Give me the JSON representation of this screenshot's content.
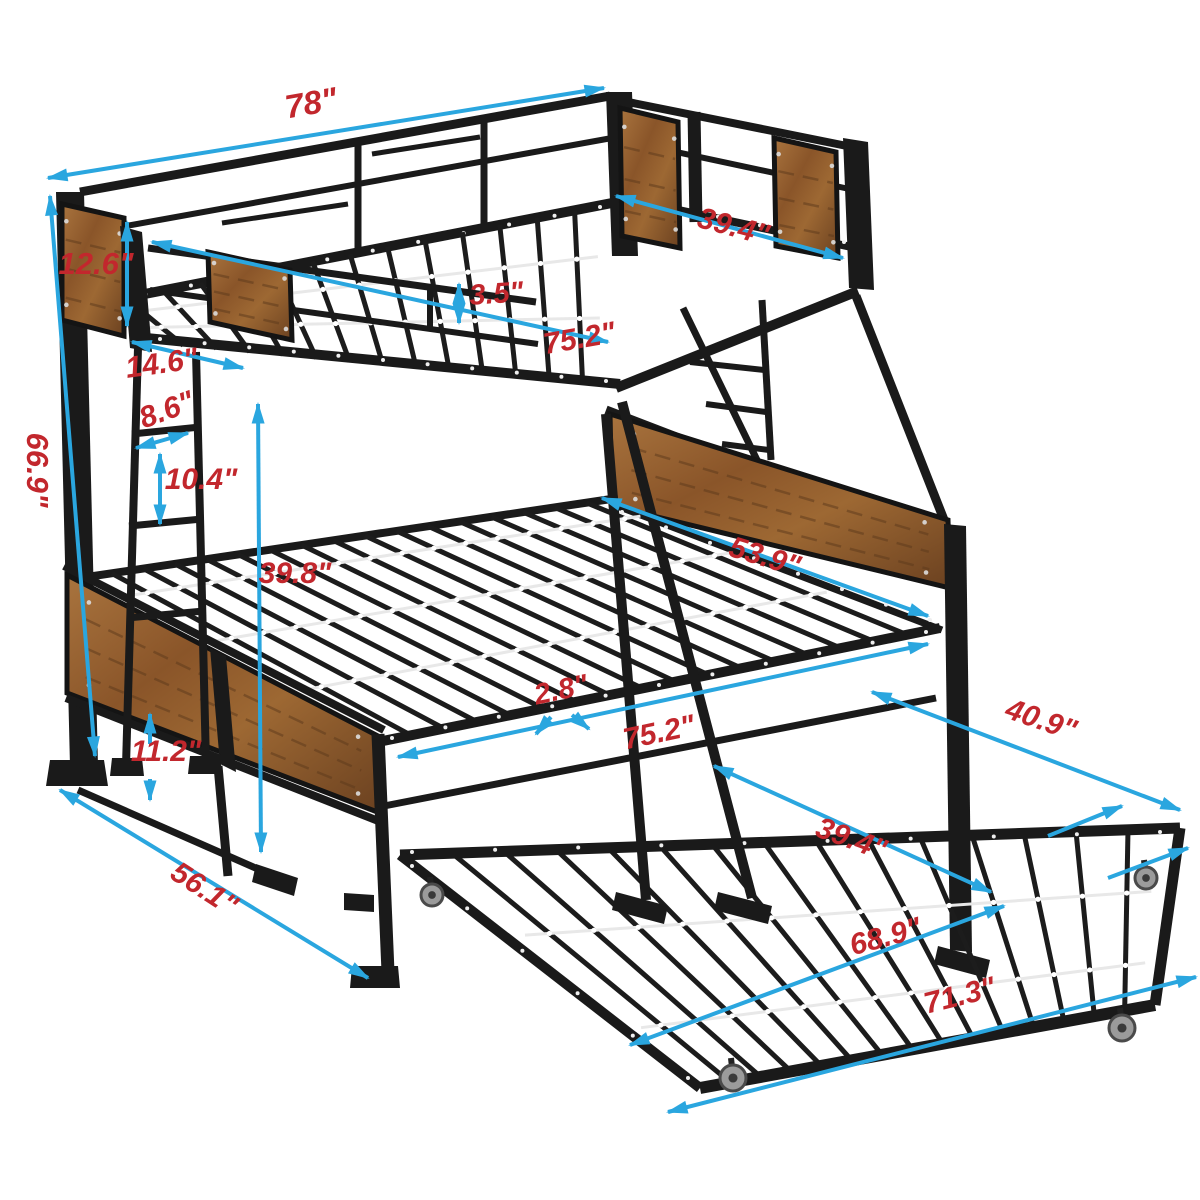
{
  "diagram": {
    "subject": "twin-over-full metal bunk bed with pull-out trundle",
    "unit": "inches",
    "colors": {
      "background": "#ffffff",
      "metal": "#1a1a1a",
      "metal_soft": "#242424",
      "wood_light": "#a9743e",
      "wood_mid": "#8a5529",
      "wood_dark": "#6b4120",
      "wood_grain": "#5d3a1c",
      "dimension_line": "#2AA6DF",
      "dimension_text": "#C2272D",
      "slat_rod": "#e8e8e8",
      "rod_clip": "#ffffff",
      "screw_dot": "#efefef",
      "caster_wheel": "#9b9b9b",
      "caster_hub": "#3a3a3a"
    },
    "dimensions": [
      {
        "id": "overall-length",
        "label": "78\"",
        "value": 78,
        "pos": {
          "x": 313,
          "y": 114,
          "rot": -10,
          "size": 33
        },
        "lines": [
          {
            "x1": 48,
            "y1": 178,
            "x2": 604,
            "y2": 88,
            "heads": "both"
          }
        ]
      },
      {
        "id": "overall-height",
        "label": "66.9\"",
        "value": 66.9,
        "pos": {
          "x": 27,
          "y": 470,
          "rot": 90,
          "size": 31
        },
        "lines": [
          {
            "x1": 50,
            "y1": 196,
            "x2": 95,
            "y2": 756,
            "heads": "both"
          }
        ]
      },
      {
        "id": "upper-panel-height",
        "label": "12.6\"",
        "value": 12.6,
        "pos": {
          "x": 96,
          "y": 274,
          "rot": 0,
          "size": 31
        },
        "lines": [
          {
            "x1": 127,
            "y1": 222,
            "x2": 127,
            "y2": 326,
            "heads": "both"
          }
        ]
      },
      {
        "id": "upper-width",
        "label": "39.4\"",
        "value": 39.4,
        "pos": {
          "x": 731,
          "y": 236,
          "rot": 15,
          "size": 30
        },
        "lines": [
          {
            "x1": 616,
            "y1": 196,
            "x2": 843,
            "y2": 258,
            "heads": "both"
          }
        ]
      },
      {
        "id": "guardrail-height",
        "label": "3.5\"",
        "value": 3.5,
        "pos": {
          "x": 497,
          "y": 303,
          "rot": -4,
          "size": 29
        },
        "lines": [
          {
            "x1": 459,
            "y1": 284,
            "x2": 459,
            "y2": 323,
            "heads": "both"
          }
        ]
      },
      {
        "id": "upper-sleep-length",
        "label": "75.2\"",
        "value": 75.2,
        "pos": {
          "x": 581,
          "y": 348,
          "rot": -10,
          "size": 30
        },
        "lines": [
          {
            "x1": 152,
            "y1": 242,
            "x2": 608,
            "y2": 342,
            "heads": "both"
          }
        ]
      },
      {
        "id": "ladder-depth",
        "label": "14.6\"",
        "value": 14.6,
        "pos": {
          "x": 163,
          "y": 373,
          "rot": -8,
          "size": 30
        },
        "lines": [
          {
            "x1": 132,
            "y1": 342,
            "x2": 243,
            "y2": 368,
            "heads": "both"
          }
        ]
      },
      {
        "id": "rung-width",
        "label": "8.6\"",
        "value": 8.6,
        "pos": {
          "x": 170,
          "y": 419,
          "rot": -20,
          "size": 30
        },
        "lines": [
          {
            "x1": 136,
            "y1": 448,
            "x2": 188,
            "y2": 433,
            "heads": "both"
          }
        ]
      },
      {
        "id": "rung-spacing",
        "label": "10.4\"",
        "value": 10.4,
        "pos": {
          "x": 201,
          "y": 489,
          "rot": 0,
          "size": 30
        },
        "lines": [
          {
            "x1": 160,
            "y1": 454,
            "x2": 160,
            "y2": 524,
            "heads": "both"
          }
        ]
      },
      {
        "id": "bunk-clearance",
        "label": "39.8\"",
        "value": 39.8,
        "pos": {
          "x": 295,
          "y": 583,
          "rot": 0,
          "size": 30
        },
        "lines": [
          {
            "x1": 258,
            "y1": 404,
            "x2": 261,
            "y2": 852,
            "heads": "both"
          }
        ]
      },
      {
        "id": "lower-panel-gap",
        "label": "11.2\"",
        "value": 11.2,
        "pos": {
          "x": 166,
          "y": 761,
          "rot": 0,
          "size": 30
        },
        "lines": [
          {
            "x1": 150,
            "y1": 744,
            "x2": 150,
            "y2": 714,
            "heads": "end"
          },
          {
            "x1": 150,
            "y1": 779,
            "x2": 150,
            "y2": 800,
            "heads": "end"
          }
        ]
      },
      {
        "id": "lower-depth",
        "label": "56.1\"",
        "value": 56.1,
        "pos": {
          "x": 199,
          "y": 897,
          "rot": 33,
          "size": 30
        },
        "lines": [
          {
            "x1": 60,
            "y1": 790,
            "x2": 368,
            "y2": 978,
            "heads": "both"
          }
        ]
      },
      {
        "id": "lower-width",
        "label": "53.9\"",
        "value": 53.9,
        "pos": {
          "x": 762,
          "y": 566,
          "rot": 17,
          "size": 30
        },
        "lines": [
          {
            "x1": 602,
            "y1": 498,
            "x2": 928,
            "y2": 616,
            "heads": "both"
          }
        ]
      },
      {
        "id": "slat-spacing",
        "label": "2.8\"",
        "value": 2.8,
        "pos": {
          "x": 563,
          "y": 699,
          "rot": -12,
          "size": 29
        },
        "lines": [
          {
            "x1": 551,
            "y1": 717,
            "x2": 536,
            "y2": 734,
            "heads": "end"
          },
          {
            "x1": 572,
            "y1": 715,
            "x2": 589,
            "y2": 729,
            "heads": "end"
          }
        ]
      },
      {
        "id": "lower-sleep-length",
        "label": "75.2\"",
        "value": 75.2,
        "pos": {
          "x": 661,
          "y": 742,
          "rot": -12,
          "size": 30
        },
        "lines": [
          {
            "x1": 398,
            "y1": 757,
            "x2": 928,
            "y2": 644,
            "heads": "both"
          }
        ]
      },
      {
        "id": "trundle-depth",
        "label": "40.9\"",
        "value": 40.9,
        "pos": {
          "x": 1038,
          "y": 729,
          "rot": 19,
          "size": 30
        },
        "lines": [
          {
            "x1": 872,
            "y1": 692,
            "x2": 1180,
            "y2": 810,
            "heads": "both"
          },
          {
            "x1": 1048,
            "y1": 836,
            "x2": 1122,
            "y2": 806,
            "heads": "end"
          },
          {
            "x1": 1108,
            "y1": 878,
            "x2": 1188,
            "y2": 848,
            "heads": "end"
          }
        ]
      },
      {
        "id": "trundle-width",
        "label": "39.4\"",
        "value": 39.4,
        "pos": {
          "x": 848,
          "y": 848,
          "rot": 20,
          "size": 30
        },
        "lines": [
          {
            "x1": 714,
            "y1": 766,
            "x2": 991,
            "y2": 892,
            "heads": "both"
          }
        ]
      },
      {
        "id": "trundle-sleep-length",
        "label": "68.9\"",
        "value": 68.9,
        "pos": {
          "x": 888,
          "y": 946,
          "rot": -15,
          "size": 30
        },
        "lines": [
          {
            "x1": 630,
            "y1": 1045,
            "x2": 1004,
            "y2": 906,
            "heads": "both"
          }
        ]
      },
      {
        "id": "trundle-length",
        "label": "71.3\"",
        "value": 71.3,
        "pos": {
          "x": 962,
          "y": 1005,
          "rot": -14,
          "size": 30
        },
        "lines": [
          {
            "x1": 668,
            "y1": 1112,
            "x2": 1196,
            "y2": 977,
            "heads": "both"
          }
        ]
      }
    ]
  }
}
